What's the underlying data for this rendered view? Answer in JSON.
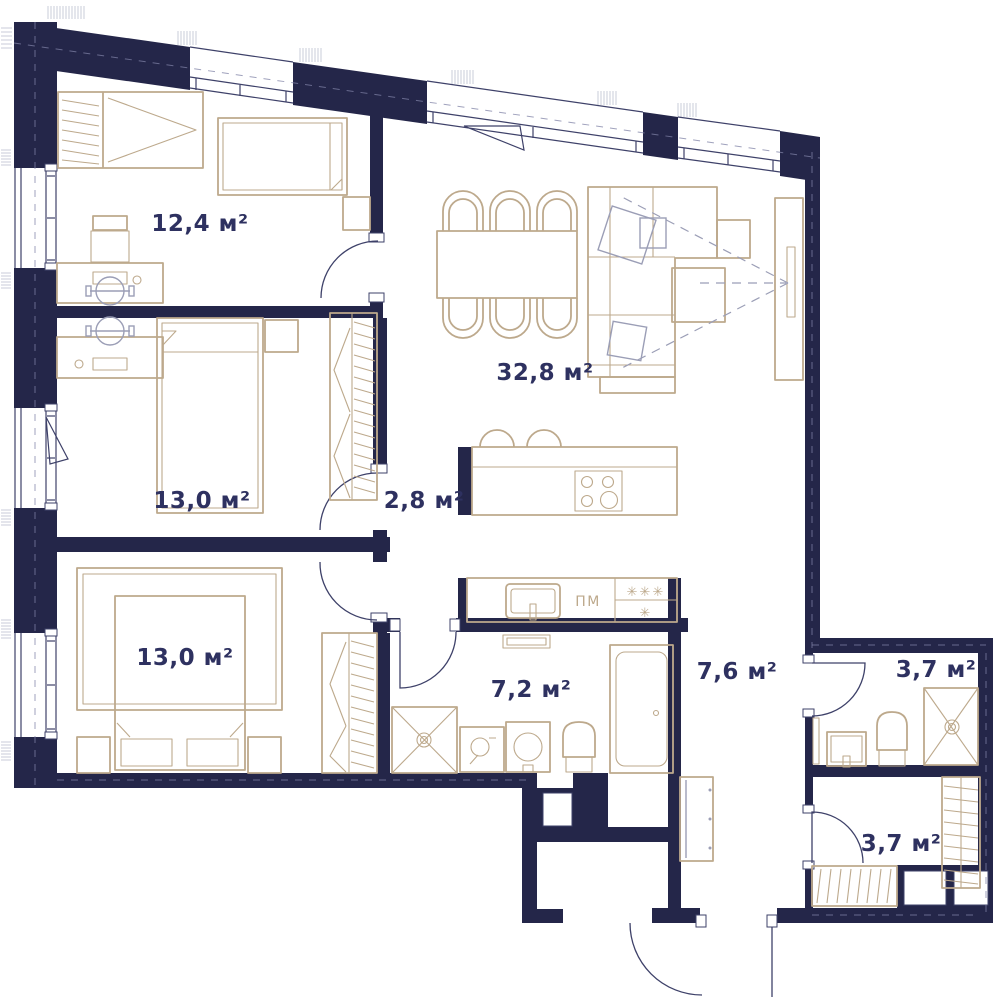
{
  "colors": {
    "bg": "#ffffff",
    "wall": "#242649",
    "line": "#3e4169",
    "furniture": "#bda98c",
    "furniture_gray": "#9b9eb6",
    "text": "#2e3160",
    "axis": "#7f82a6",
    "vent": "#d3d5e0"
  },
  "rooms": [
    {
      "id": "bedroom-1",
      "label": "12,4 м²"
    },
    {
      "id": "bedroom-2",
      "label": "13,0 м²"
    },
    {
      "id": "bedroom-3",
      "label": "13,0 м²"
    },
    {
      "id": "living-kitchen",
      "label": "32,8 м²"
    },
    {
      "id": "corridor",
      "label": "2,8 м²"
    },
    {
      "id": "bathroom",
      "label": "7,2 м²"
    },
    {
      "id": "hallway",
      "label": "7,6 м²"
    },
    {
      "id": "shower-room",
      "label": "3,7 м²"
    },
    {
      "id": "dressing-room",
      "label": "3,7 м²"
    }
  ],
  "appliances": {
    "dishwasher": "ПМ",
    "fridge_top": "✳✳✳",
    "fridge_bottom": "✳"
  }
}
